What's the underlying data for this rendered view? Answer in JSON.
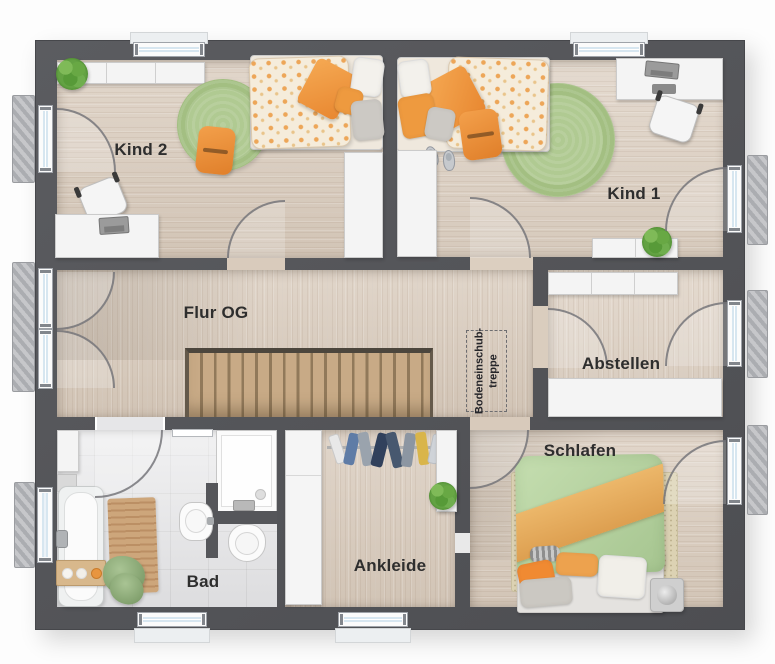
{
  "rooms": [
    {
      "id": "kind-2",
      "label": "Kind 2"
    },
    {
      "id": "kind-1",
      "label": "Kind 1"
    },
    {
      "id": "flur-og",
      "label": "Flur OG"
    },
    {
      "id": "abstellen",
      "label": "Abstellen"
    },
    {
      "id": "schlafen",
      "label": "Schlafen"
    },
    {
      "id": "ankleide",
      "label": "Ankleide"
    },
    {
      "id": "bad",
      "label": "Bad"
    }
  ],
  "annotations": {
    "attic_hatch": {
      "line1": "Bodeneinschub-",
      "line2": "treppe"
    }
  },
  "furniture_symbols": {
    "kind_2": [
      "wall-cabinet",
      "plant",
      "single-bed",
      "round-rug",
      "floor-cushion",
      "desk",
      "desk-chair",
      "wardrobe"
    ],
    "kind_1": [
      "single-bed",
      "slippers",
      "round-rug",
      "floor-cushion",
      "desk",
      "desk-chair",
      "wardrobe",
      "sideboard",
      "plant"
    ],
    "flur_og": [
      "staircase",
      "attic-hatch"
    ],
    "abstellen": [
      "wall-cabinet",
      "cabinet"
    ],
    "bad": [
      "bathtub",
      "bath-caddy",
      "wooden-mat",
      "towels",
      "sink",
      "toilet",
      "shower",
      "towel-rail",
      "cabinet"
    ],
    "ankleide": [
      "wardrobe",
      "clothes-rail",
      "shelf",
      "plant"
    ],
    "schlafen": [
      "double-bed",
      "rug",
      "side-cube"
    ]
  },
  "colors": {
    "wall": "#55565a",
    "wood_floor": "#d9cbbc",
    "tile_floor": "#e4e4e6",
    "stair_tread": "#c8aa86",
    "rug_green": "#a3bf82",
    "accent_orange": "#ee9440",
    "duvet_green": "#b8d2a2",
    "blanket_orange": "#e6ae62",
    "furniture_white": "#f4f4f4",
    "window_glass": "#d7e6f0",
    "plant_green": "#63a243",
    "label_text": "#2e2e2e"
  }
}
